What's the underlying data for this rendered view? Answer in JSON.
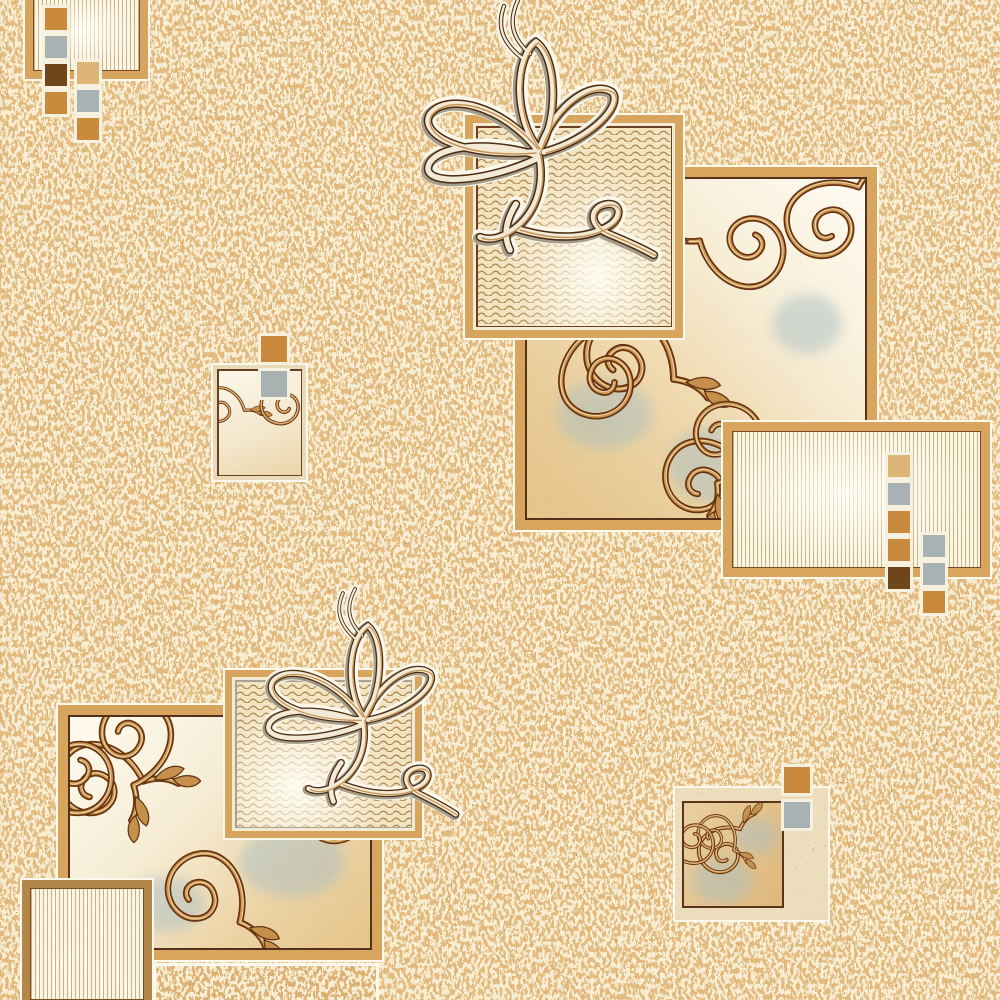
{
  "meta": {
    "kind": "carpet textile pattern",
    "style": "beige ornamental rug print with scroll vines, ribbon flourishes, wavy and striped panels",
    "canvas": "1000x1000"
  },
  "palette": {
    "base": "#e3ba7e",
    "speckleCream": "#f8eed3",
    "speckleBrown": "#bf8b4b",
    "white": "#fcf8ec",
    "tanBand": "#d8a55e",
    "tanBandDark": "#b3864a",
    "darkLine": "#55301a",
    "thinBrown": "#6a4020",
    "grayLine": "#a8a296",
    "cream": "#f3ead2",
    "waveLine": "#b28b52",
    "waveBg": "#f2e3c1",
    "stripeLine": "#c9b283",
    "stripeBg": "#fbf5e3",
    "scrollDark": "#693310",
    "scrollMid": "#cf9c58",
    "scrollHi": "#eed6a8",
    "leaf": "#c6904c",
    "blueGray": "#a9b2b2",
    "orange": "#c98a3e",
    "darkBrown": "#6f451c",
    "tan": "#dcb577",
    "ribbonShadow": "#a39c8a",
    "ribbonDark": "#4c2c10",
    "ribbonCream": "#f2ead6",
    "ribbonTan": "#c89454",
    "matBand": "#ecddbd"
  },
  "elements": {
    "background": {
      "label": "speckled beige carpet ground"
    },
    "topLeftStriped": {
      "label": "striped rectangle cut by top edge"
    },
    "topLeftCluster": {
      "label": "two columns of color squares",
      "colA": [
        "orange",
        "blueGray",
        "darkBrown",
        "orange"
      ],
      "colB": [
        "tan",
        "blueGray",
        "orange"
      ]
    },
    "rightScroll": {
      "label": "large scroll-vine square"
    },
    "topWavy": {
      "label": "wavy-pattern square"
    },
    "topRibbon": {
      "label": "calligraphic ribbon flourish"
    },
    "rightStriped": {
      "label": "striped rectangle"
    },
    "rightCluster": {
      "label": "two columns of color squares",
      "colA": [
        "tan",
        "blueGray",
        "orange",
        "orange",
        "darkBrown"
      ],
      "colB": [
        "blueGray",
        "blueGray",
        "orange"
      ]
    },
    "midLeftScroll": {
      "label": "small scroll-vine rectangle"
    },
    "midLeftCluster": {
      "label": "pair of color squares",
      "colA": [
        "orange",
        "blueGray"
      ]
    },
    "bottomLeftScroll": {
      "label": "large scroll-vine square"
    },
    "bottomWavy": {
      "label": "wavy-pattern square"
    },
    "bottomRibbon": {
      "label": "calligraphic ribbon flourish"
    },
    "bottomLeftStriped": {
      "label": "striped rectangle cut by bottom edge"
    },
    "bottomStrip": {
      "label": "partial speckled panel cut by bottom edge"
    },
    "bottomRightScroll": {
      "label": "small scroll square with mat frame"
    },
    "bottomRightCluster": {
      "label": "pair of color squares",
      "colA": [
        "orange",
        "blueGray"
      ]
    }
  }
}
